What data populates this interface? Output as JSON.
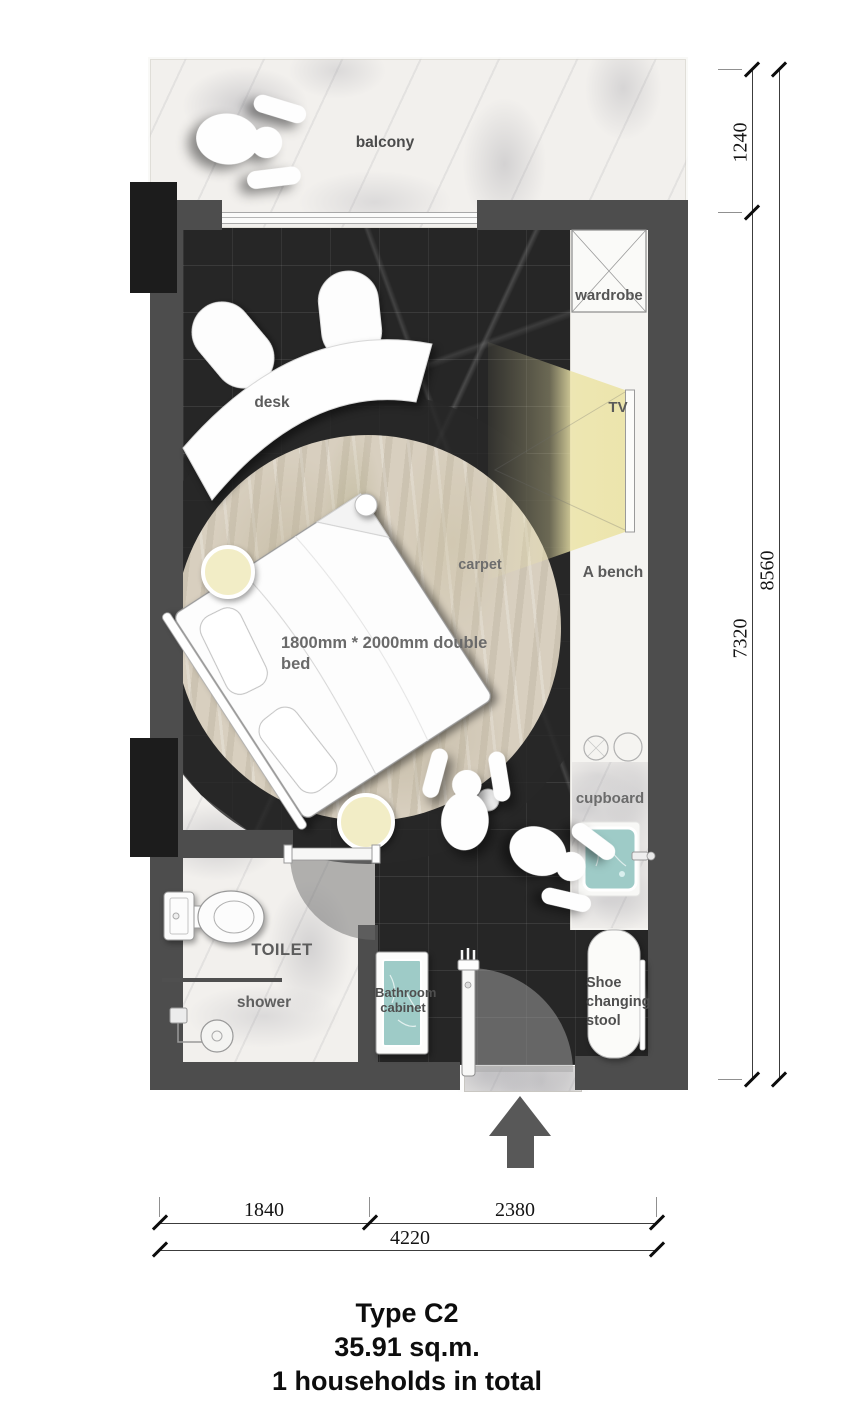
{
  "plan": {
    "type_label": "floor-plan",
    "labels": {
      "balcony": "balcony",
      "wardrobe": "wardrobe",
      "tv": "TV",
      "bench": "A bench",
      "desk": "desk",
      "carpet": "carpet",
      "bed": "1800mm * 2000mm double bed",
      "cupboard": "cupboard",
      "toilet": "TOILET",
      "shower": "shower",
      "bathroom_cabinet": "Bathroom cabinet",
      "shoe_stool": "Shoe changing stool"
    },
    "dimensions": {
      "right": [
        {
          "label": "1240"
        },
        {
          "label": "7320"
        },
        {
          "label": "8560"
        }
      ],
      "bottom": [
        {
          "label": "1840"
        },
        {
          "label": "2380"
        },
        {
          "label": "4220"
        }
      ]
    },
    "title": {
      "line1": "Type C2",
      "line2": "35.91 sq.m.",
      "line3": "1 households in total"
    },
    "icons": {
      "entrance_arrow": "up-arrow",
      "persons": "top-view-person-figure"
    },
    "colors": {
      "wall": "#4d4d4d",
      "column": "#1c1c1c",
      "floor_dark": "#262626",
      "marble_light": "#f2f0ed",
      "carpet": "#d8cfbf",
      "accent_teal": "#9ecbc7",
      "tv_light_cone": "#ece4a9",
      "furniture": "#ffffff",
      "label_text": "#5e5e5e"
    }
  }
}
